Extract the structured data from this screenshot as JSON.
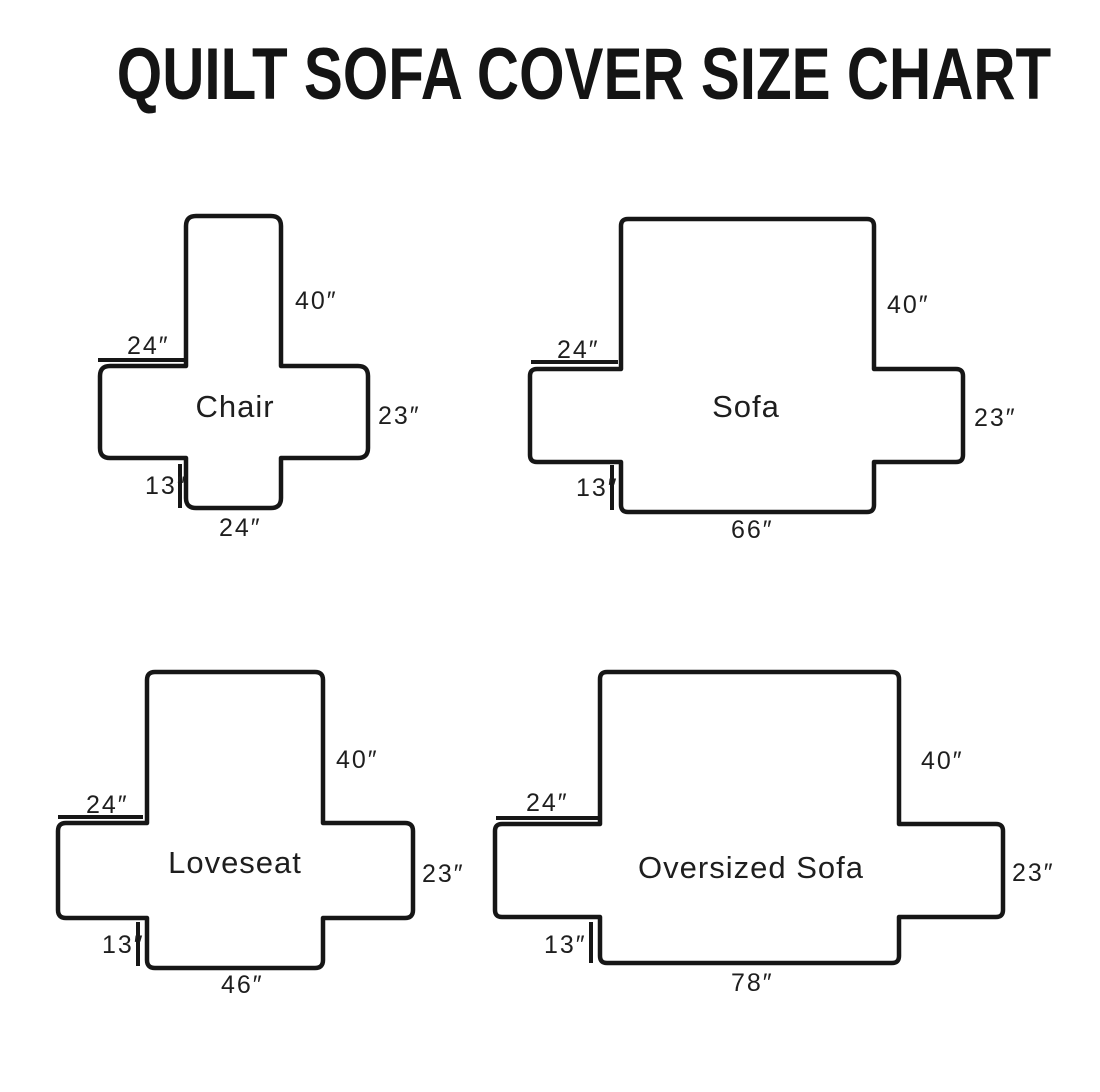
{
  "title": "QUILT SOFA COVER SIZE CHART",
  "diagrams": [
    {
      "name": "Chair",
      "back_height": "40″",
      "arm_width": "24″",
      "side_height": "23″",
      "front_drop": "13″",
      "bottom_width": "24″"
    },
    {
      "name": "Sofa",
      "back_height": "40″",
      "arm_width": "24″",
      "side_height": "23″",
      "front_drop": "13″",
      "bottom_width": "66″"
    },
    {
      "name": "Loveseat",
      "back_height": "40″",
      "arm_width": "24″",
      "side_height": "23″",
      "front_drop": "13″",
      "bottom_width": "46″"
    },
    {
      "name": "Oversized Sofa",
      "back_height": "40″",
      "arm_width": "24″",
      "side_height": "23″",
      "front_drop": "13″",
      "bottom_width": "78″"
    }
  ]
}
